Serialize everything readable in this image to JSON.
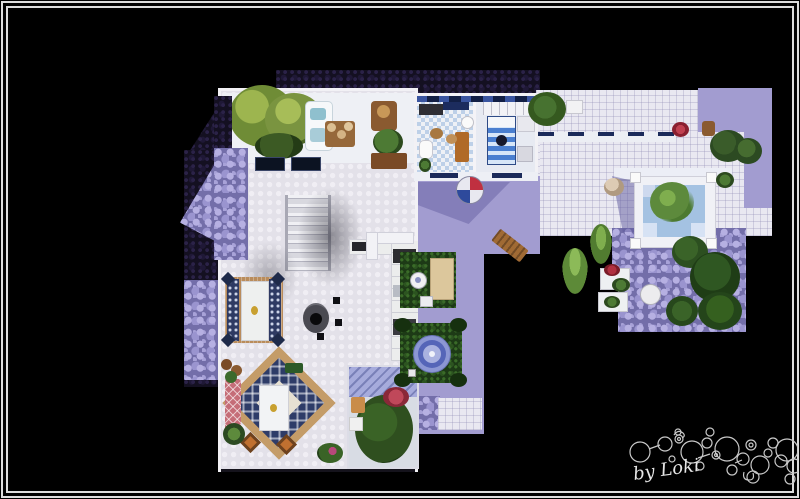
{
  "signature": {
    "text": "by Loki"
  },
  "frame": {
    "style": "double white rule on black background",
    "color": "#dcdcdc"
  },
  "palette": {
    "background": "#000000",
    "cobblestone": "#8d88c4",
    "cobblestone_light": "#b5b0de",
    "stucco": "#e9e8f1",
    "interior_floor": "#e3e1e9",
    "wall_white": "#f2f1f5",
    "wall_navy": "#1b2a5a",
    "hedge_green": "#24421c",
    "foliage_green": "#3f6b2e",
    "tree_yellow_green": "#85a243",
    "pool_water": "#a4c2e2",
    "bed_blue": "#4a7fd0",
    "rug_tan": "#c09a66",
    "rug_navy": "#2e3c68",
    "night_ground": "#141021",
    "wood_brown": "#8a5a30",
    "fountain_ring": "#5565b8"
  },
  "scene": {
    "description": "Overhead screenshot of a Sims lot: white-walled house with lavender cobblestone courtyards",
    "areas": [
      "atrium with citrus trees",
      "skylit hall with staircase",
      "dining room with banquet table",
      "kitchen",
      "fire pit lounge",
      "covered patio with dining set",
      "conservatory with shrubs",
      "bathroom with checkered floor",
      "bedroom with blue double bed",
      "courtyard garden with birdbath",
      "courtyard garden with round fountain",
      "spa pool with planting",
      "shrub garden with planters",
      "cobblestone plaza",
      "stucco terrace"
    ]
  }
}
